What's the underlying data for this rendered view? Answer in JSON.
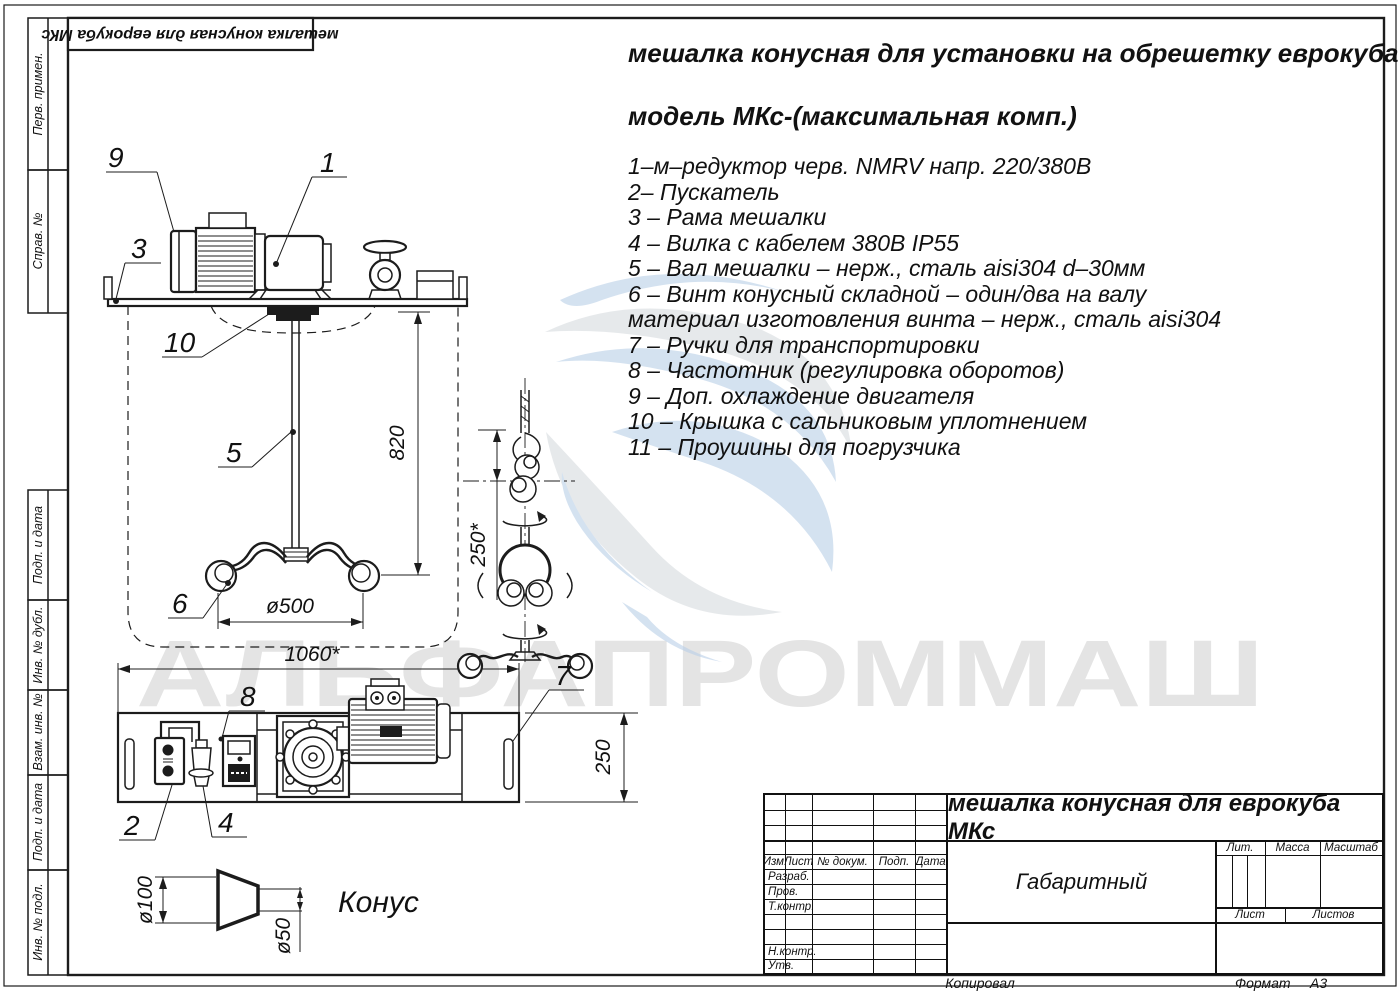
{
  "colors": {
    "line": "#1c1c1c",
    "watermark_gray": "#e4e4e4",
    "logo_blue": "#b9cfe7",
    "logo_gray": "#d7dbdf"
  },
  "top_stamp": {
    "text": "мешалка конусная для еврокуба МКс"
  },
  "side_strip": {
    "labels": [
      "Перв. примен.",
      "Справ. №",
      "Подп. и дата",
      "Инв. № дубл.",
      "Взам. инв. №",
      "Подп. и дата",
      "Инв. № подл."
    ]
  },
  "header": {
    "title_line": "мешалка конусная для установки на обрешетку еврокуба",
    "model_line": "модель МКс-(максимальная комп.)"
  },
  "parts_list": {
    "lines": [
      "1–м–редуктор черв. NMRV напр. 220/380В",
      "2– Пускатель",
      "3 – Рама мешалки",
      "4 – Вилка с кабелем 380В IP55",
      "5 – Вал мешалки – нерж., сталь aisi304 d–30мм",
      "6 – Винт конусный складной – один/два на валу",
      "материал изготовления винта – нерж., сталь aisi304",
      "7 – Ручки для транспортировки",
      "8 – Частотник (регулировка оборотов)",
      "9 – Доп. охлаждение двигателя",
      "10 – Крышка с сальниковым уплотнением",
      "11 – Проушины для погрузчика"
    ]
  },
  "watermark": {
    "text": "АЛЬФАПРОММАШ"
  },
  "drawing": {
    "callouts": {
      "c1": "1",
      "c2": "2",
      "c3": "3",
      "c4": "4",
      "c5": "5",
      "c6": "6",
      "c7": "7",
      "c8": "8",
      "c9": "9",
      "c10": "10"
    },
    "dims": {
      "shaft_length": "820",
      "screw_diameter": "ø500",
      "overall_width": "1060*",
      "folded_size": "250*",
      "frame_depth": "250",
      "cone_large": "ø100",
      "cone_small": "ø50"
    },
    "cone_caption": "Конус"
  },
  "title_block": {
    "product_title": "мешалка конусная для еврокуба МКс",
    "drawing_kind": "Габаритный",
    "header_cells": {
      "izm": "Изм.",
      "list": "Лист",
      "doc_num": "№ докум.",
      "podp": "Подп.",
      "data": "Дата"
    },
    "row_labels": {
      "razrab": "Разраб.",
      "prov": "Пров.",
      "t_kontr": "Т.контр.",
      "n_kontr": "Н.контр.",
      "utv": "Утв."
    },
    "right_cells": {
      "lit": "Лит.",
      "massa": "Масса",
      "masshtab": "Масштаб",
      "list": "Лист",
      "listov": "Листов"
    },
    "footer": {
      "kopiroval": "Копировал",
      "format_label": "Формат",
      "format_value": "А3"
    }
  }
}
